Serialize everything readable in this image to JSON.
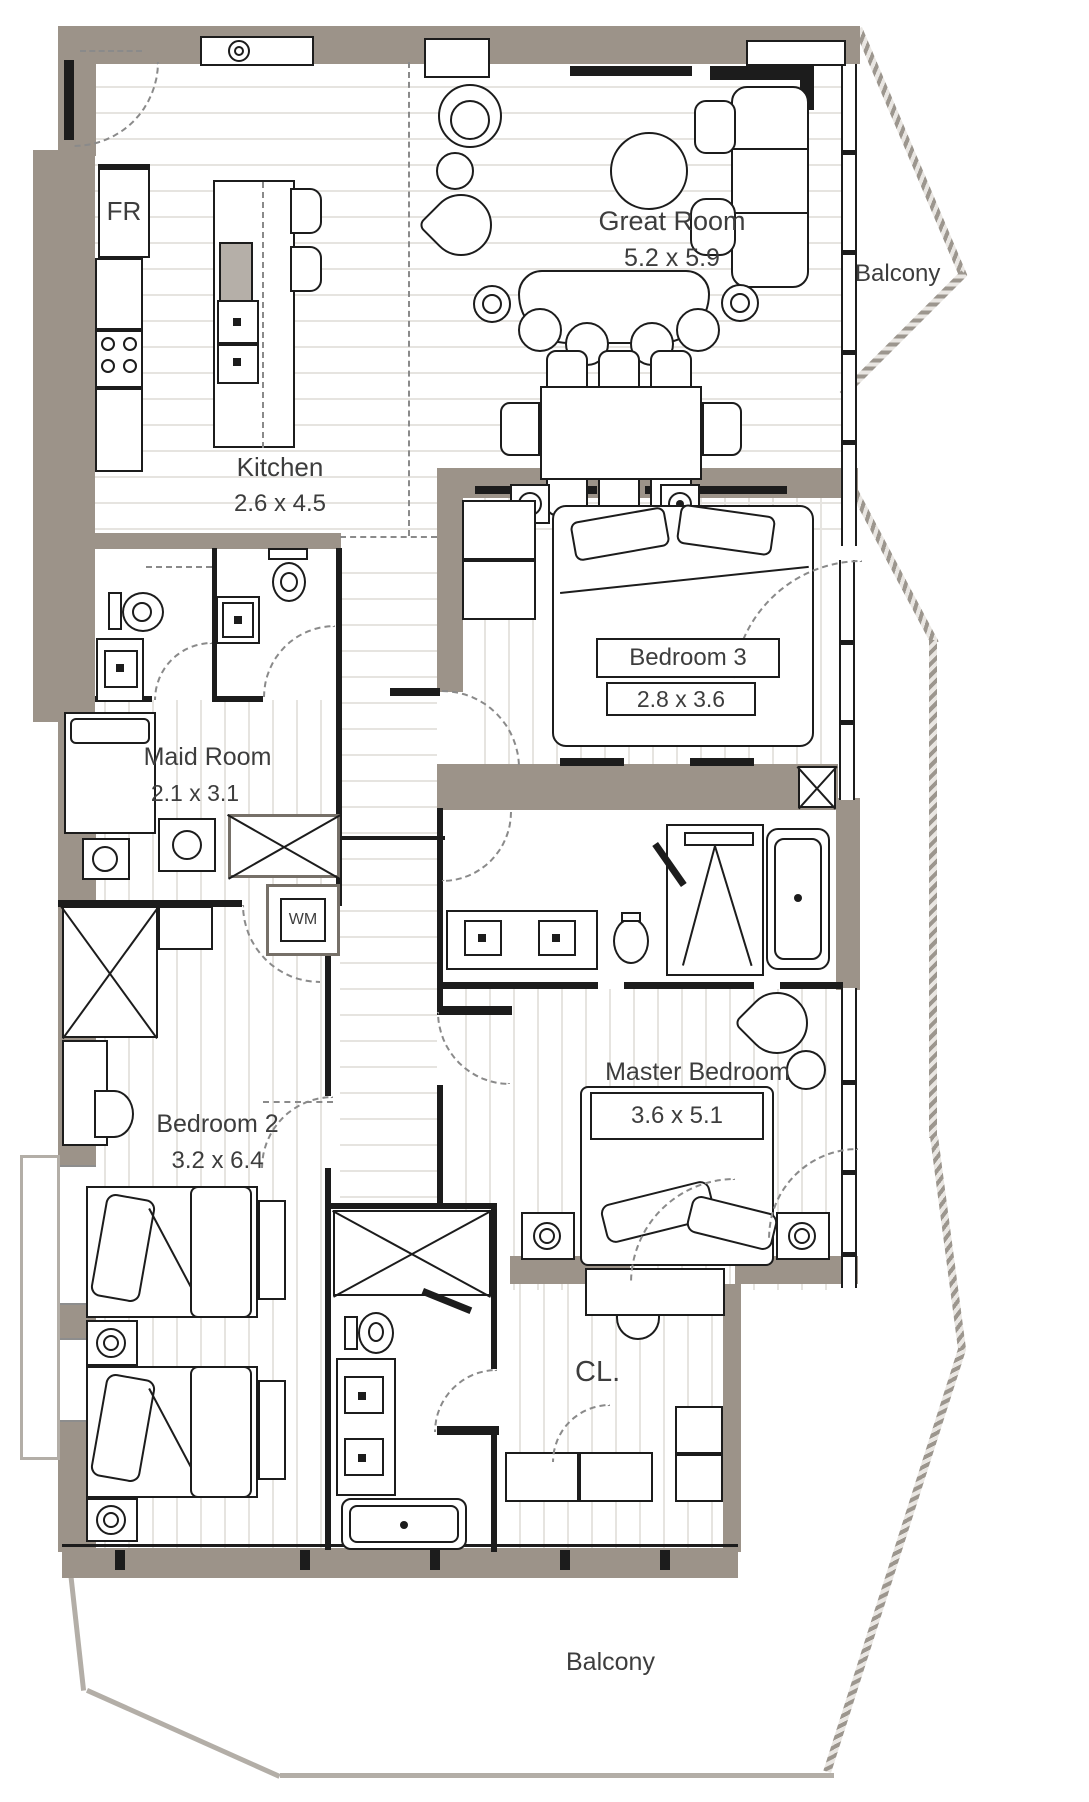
{
  "rooms": [
    {
      "id": "great-room",
      "label": "Great Room",
      "dims": "5.2 x 5.9"
    },
    {
      "id": "kitchen",
      "label": "Kitchen",
      "dims": "2.6 x 4.5"
    },
    {
      "id": "bedroom-3",
      "label": "Bedroom 3",
      "dims": "2.8 x 3.6"
    },
    {
      "id": "maid-room",
      "label": "Maid Room",
      "dims": "2.1 x 3.1"
    },
    {
      "id": "master-bedroom",
      "label": "Master Bedroom",
      "dims": "3.6 x 5.1"
    },
    {
      "id": "bedroom-2",
      "label": "Bedroom 2",
      "dims": "3.2 x 6.4"
    },
    {
      "id": "closet",
      "label": "CL."
    }
  ],
  "balconies": [
    {
      "id": "balcony-right",
      "label": "Balcony"
    },
    {
      "id": "balcony-bottom",
      "label": "Balcony"
    }
  ],
  "appliances": {
    "fridge": "FR",
    "washer": "WM"
  },
  "colors": {
    "wall": "#9c9389",
    "line": "#1c1c1c",
    "floor_stripe": "#e6e4e0",
    "hatch": "#9c968e",
    "text": "#3d3d3d"
  }
}
